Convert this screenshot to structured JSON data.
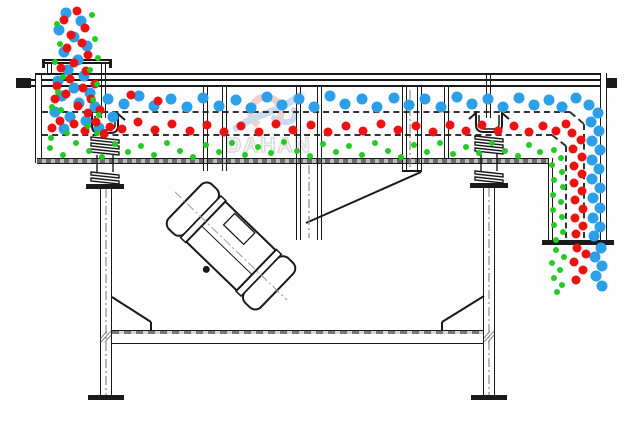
{
  "diagram": {
    "title": "linear-vibrating-screen-cross-section",
    "watermark": {
      "brand": "DAHAN",
      "reg": "®"
    }
  },
  "colors": {
    "line": "#1a1a1a",
    "coarse_particles": "#2b9fe8",
    "medium_particles": "#ee1111",
    "fine_particles": "#22cc22",
    "watermark_gray": "#c6c6c6",
    "watermark_red": "#f0b2a8",
    "watermark_blue": "#a9c6e6"
  },
  "particles": {
    "coarse_blue": {
      "color": "#2b9fe8",
      "size": 11,
      "points": [
        [
          66,
          13
        ],
        [
          81,
          21
        ],
        [
          59,
          30
        ],
        [
          74,
          37
        ],
        [
          87,
          46
        ],
        [
          64,
          52
        ],
        [
          78,
          60
        ],
        [
          68,
          70
        ],
        [
          84,
          76
        ],
        [
          58,
          81
        ],
        [
          74,
          88
        ],
        [
          90,
          93
        ],
        [
          62,
          96
        ],
        [
          79,
          103
        ],
        [
          95,
          107
        ],
        [
          55,
          112
        ],
        [
          70,
          117
        ],
        [
          86,
          121
        ],
        [
          99,
          128
        ],
        [
          64,
          129
        ],
        [
          108,
          99
        ],
        [
          113,
          117
        ],
        [
          124,
          104
        ],
        [
          139,
          96
        ],
        [
          154,
          106
        ],
        [
          171,
          99
        ],
        [
          187,
          107
        ],
        [
          203,
          98
        ],
        [
          219,
          106
        ],
        [
          236,
          100
        ],
        [
          251,
          108
        ],
        [
          267,
          97
        ],
        [
          282,
          105
        ],
        [
          299,
          99
        ],
        [
          314,
          107
        ],
        [
          330,
          96
        ],
        [
          345,
          104
        ],
        [
          362,
          99
        ],
        [
          377,
          107
        ],
        [
          394,
          98
        ],
        [
          409,
          105
        ],
        [
          425,
          99
        ],
        [
          441,
          107
        ],
        [
          457,
          97
        ],
        [
          472,
          104
        ],
        [
          488,
          99
        ],
        [
          503,
          107
        ],
        [
          519,
          98
        ],
        [
          534,
          105
        ],
        [
          549,
          100
        ],
        [
          562,
          107
        ],
        [
          576,
          98
        ],
        [
          589,
          105
        ],
        [
          598,
          113
        ],
        [
          591,
          122
        ],
        [
          599,
          131
        ],
        [
          592,
          141
        ],
        [
          600,
          150
        ],
        [
          592,
          160
        ],
        [
          599,
          169
        ],
        [
          592,
          179
        ],
        [
          600,
          188
        ],
        [
          593,
          198
        ],
        [
          600,
          208
        ],
        [
          593,
          218
        ],
        [
          600,
          227
        ],
        [
          594,
          236
        ],
        [
          601,
          248
        ],
        [
          595,
          257
        ],
        [
          602,
          266
        ],
        [
          596,
          276
        ],
        [
          602,
          286
        ]
      ]
    },
    "medium_red": {
      "color": "#ee1111",
      "size": 9,
      "points": [
        [
          77,
          11
        ],
        [
          64,
          20
        ],
        [
          85,
          28
        ],
        [
          71,
          35
        ],
        [
          82,
          43
        ],
        [
          67,
          48
        ],
        [
          88,
          55
        ],
        [
          74,
          63
        ],
        [
          61,
          68
        ],
        [
          86,
          71
        ],
        [
          70,
          79
        ],
        [
          57,
          86
        ],
        [
          83,
          88
        ],
        [
          95,
          84
        ],
        [
          66,
          94
        ],
        [
          91,
          99
        ],
        [
          78,
          106
        ],
        [
          55,
          99
        ],
        [
          100,
          110
        ],
        [
          88,
          113
        ],
        [
          60,
          121
        ],
        [
          74,
          124
        ],
        [
          96,
          122
        ],
        [
          52,
          128
        ],
        [
          85,
          131
        ],
        [
          110,
          127
        ],
        [
          104,
          134
        ],
        [
          131,
          95
        ],
        [
          158,
          101
        ],
        [
          122,
          129
        ],
        [
          138,
          122
        ],
        [
          155,
          130
        ],
        [
          172,
          124
        ],
        [
          190,
          131
        ],
        [
          207,
          125
        ],
        [
          224,
          132
        ],
        [
          241,
          126
        ],
        [
          259,
          132
        ],
        [
          276,
          124
        ],
        [
          293,
          130
        ],
        [
          311,
          125
        ],
        [
          328,
          132
        ],
        [
          346,
          126
        ],
        [
          363,
          131
        ],
        [
          381,
          124
        ],
        [
          398,
          130
        ],
        [
          416,
          126
        ],
        [
          433,
          132
        ],
        [
          450,
          125
        ],
        [
          466,
          131
        ],
        [
          482,
          125
        ],
        [
          498,
          131
        ],
        [
          514,
          126
        ],
        [
          529,
          132
        ],
        [
          543,
          126
        ],
        [
          556,
          131
        ],
        [
          566,
          124
        ],
        [
          572,
          133
        ],
        [
          581,
          140
        ],
        [
          573,
          149
        ],
        [
          582,
          157
        ],
        [
          574,
          166
        ],
        [
          582,
          174
        ],
        [
          574,
          183
        ],
        [
          582,
          191
        ],
        [
          575,
          200
        ],
        [
          583,
          209
        ],
        [
          575,
          218
        ],
        [
          583,
          226
        ],
        [
          576,
          234
        ],
        [
          577,
          248
        ],
        [
          586,
          254
        ],
        [
          574,
          262
        ],
        [
          583,
          270
        ],
        [
          576,
          280
        ]
      ]
    },
    "fine_green": {
      "color": "#22cc22",
      "size": 6,
      "points": [
        [
          92,
          15
        ],
        [
          57,
          24
        ],
        [
          95,
          39
        ],
        [
          60,
          44
        ],
        [
          98,
          58
        ],
        [
          55,
          62
        ],
        [
          90,
          70
        ],
        [
          63,
          77
        ],
        [
          97,
          84
        ],
        [
          58,
          92
        ],
        [
          93,
          100
        ],
        [
          52,
          107
        ],
        [
          99,
          115
        ],
        [
          61,
          110
        ],
        [
          88,
          126
        ],
        [
          67,
          133
        ],
        [
          97,
          133
        ],
        [
          51,
          138
        ],
        [
          50,
          148
        ],
        [
          63,
          155
        ],
        [
          76,
          143
        ],
        [
          89,
          151
        ],
        [
          102,
          157
        ],
        [
          115,
          144
        ],
        [
          128,
          152
        ],
        [
          141,
          146
        ],
        [
          154,
          155
        ],
        [
          167,
          143
        ],
        [
          180,
          151
        ],
        [
          193,
          157
        ],
        [
          206,
          145
        ],
        [
          219,
          152
        ],
        [
          232,
          143
        ],
        [
          245,
          155
        ],
        [
          258,
          147
        ],
        [
          271,
          153
        ],
        [
          284,
          142
        ],
        [
          297,
          151
        ],
        [
          310,
          156
        ],
        [
          323,
          144
        ],
        [
          336,
          152
        ],
        [
          349,
          146
        ],
        [
          362,
          155
        ],
        [
          375,
          143
        ],
        [
          388,
          151
        ],
        [
          401,
          157
        ],
        [
          414,
          145
        ],
        [
          427,
          152
        ],
        [
          440,
          143
        ],
        [
          453,
          154
        ],
        [
          466,
          147
        ],
        [
          479,
          153
        ],
        [
          492,
          143
        ],
        [
          505,
          151
        ],
        [
          518,
          156
        ],
        [
          529,
          145
        ],
        [
          540,
          152
        ],
        [
          554,
          150
        ],
        [
          561,
          158
        ],
        [
          552,
          165
        ],
        [
          562,
          172
        ],
        [
          554,
          180
        ],
        [
          563,
          187
        ],
        [
          553,
          195
        ],
        [
          561,
          202
        ],
        [
          553,
          210
        ],
        [
          562,
          217
        ],
        [
          554,
          225
        ],
        [
          563,
          232
        ],
        [
          556,
          240
        ],
        [
          556,
          250
        ],
        [
          564,
          257
        ],
        [
          552,
          263
        ],
        [
          560,
          270
        ],
        [
          554,
          278
        ],
        [
          562,
          285
        ],
        [
          557,
          292
        ]
      ]
    }
  }
}
